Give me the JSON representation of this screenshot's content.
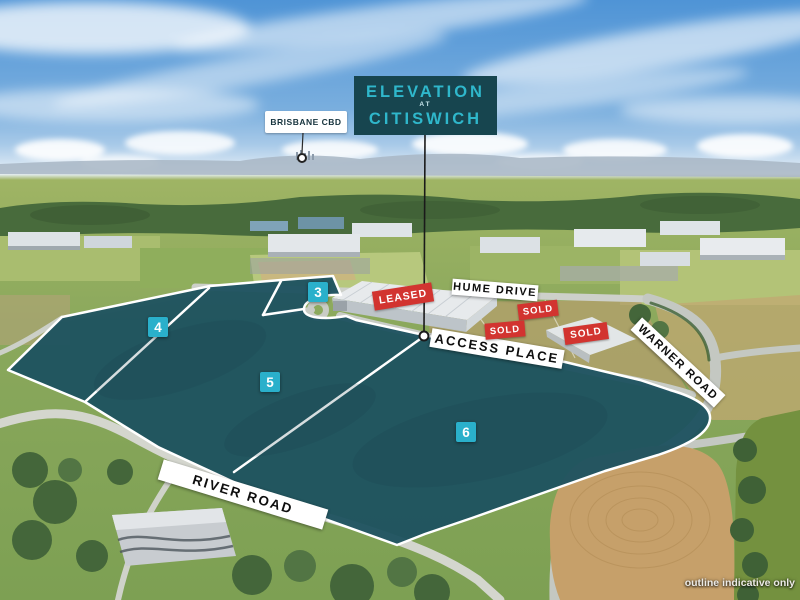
{
  "development_sign": {
    "line1": "ELEVATION",
    "line2": "AT",
    "line3": "CITISWICH"
  },
  "callouts": {
    "cbd": "BRISBANE CBD"
  },
  "road_labels": {
    "hume": "HUME DRIVE",
    "access": "ACCESS PLACE",
    "warner": "WARNER ROAD",
    "river": "RIVER ROAD"
  },
  "lots": [
    {
      "number": "3"
    },
    {
      "number": "4"
    },
    {
      "number": "5"
    },
    {
      "number": "6"
    }
  ],
  "status_badges": [
    {
      "label": "LEASED"
    },
    {
      "label": "SOLD"
    },
    {
      "label": "SOLD"
    },
    {
      "label": "SOLD"
    }
  ],
  "disclaimer": "outline indicative only",
  "colors": {
    "site_fill": "#1e5260",
    "lot_badge": "#2ab0cb",
    "status_badge": "#d23430",
    "sign_bg": "#17454f",
    "sign_text": "#2fb7cb"
  }
}
